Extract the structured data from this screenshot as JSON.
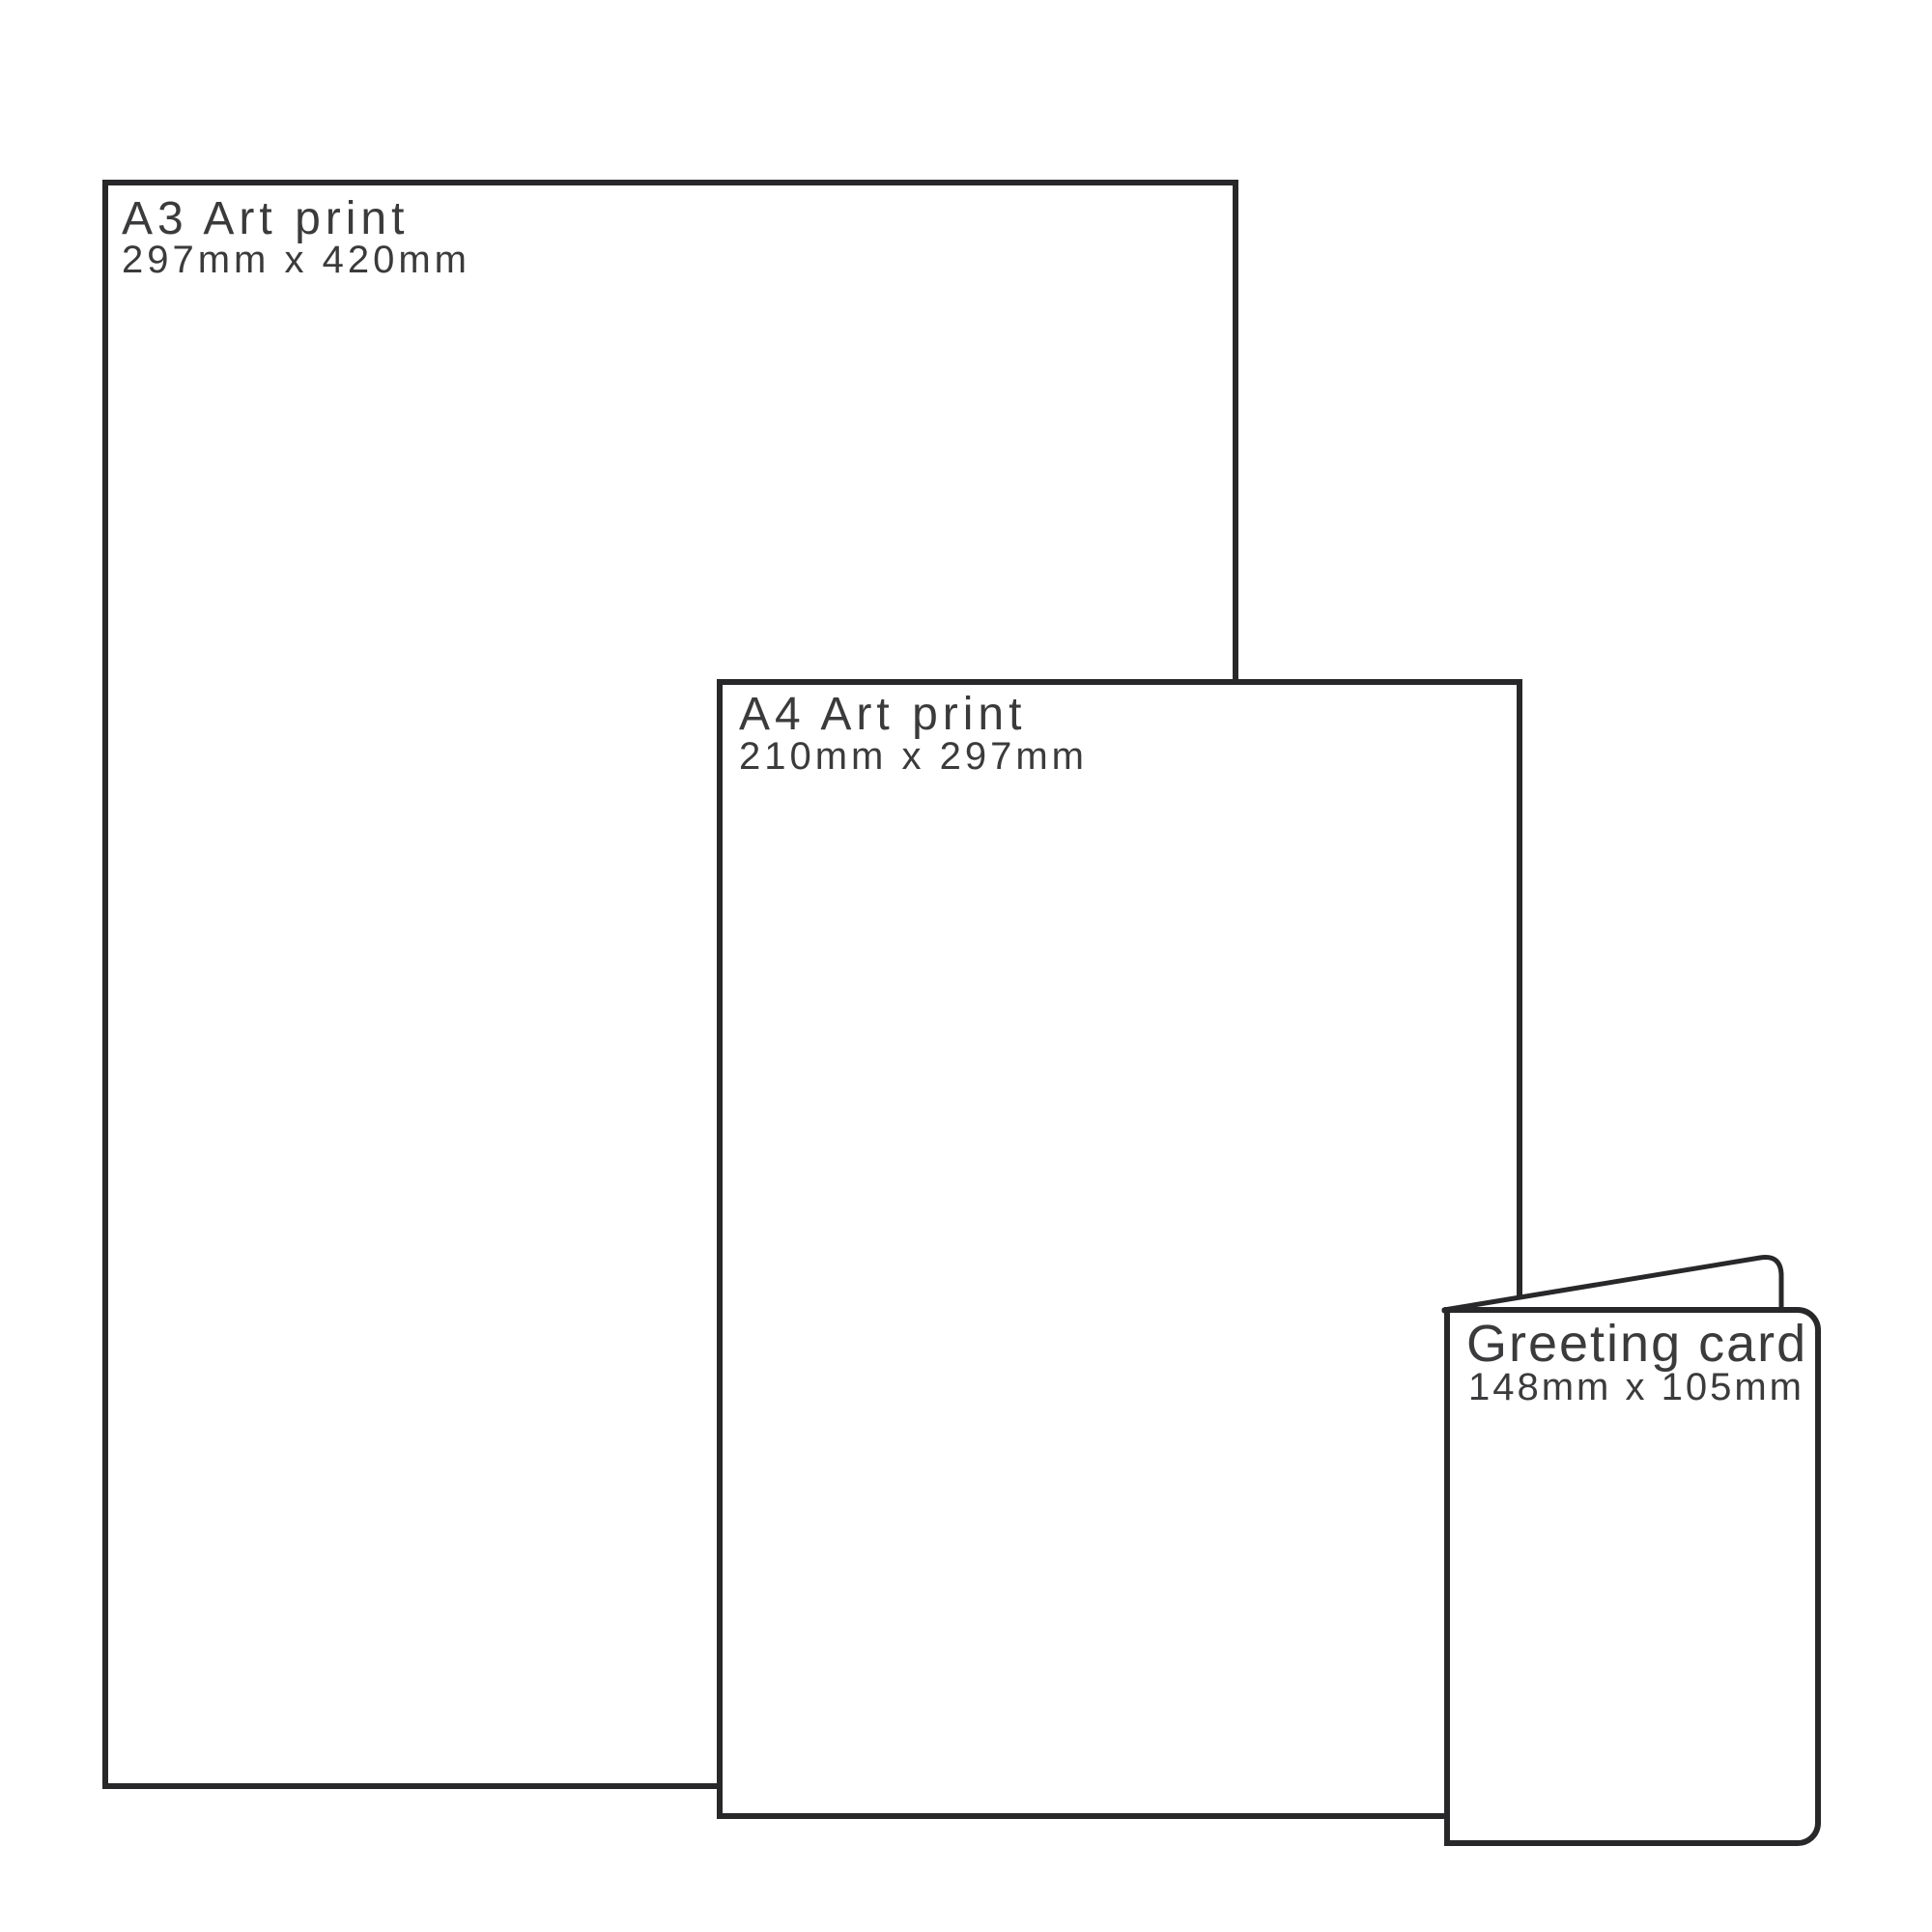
{
  "diagram": {
    "description": "Print product size comparison diagram",
    "colors": {
      "background": "#ffffff",
      "outline": "#28282a",
      "label_text": "#3b3b3d"
    },
    "items": [
      {
        "title": "A3 Art print",
        "dimensions": "297mm x 420mm"
      },
      {
        "title": "A4 Art print",
        "dimensions": "210mm x 297mm"
      },
      {
        "title": "Greeting card",
        "dimensions": "148mm x 105mm"
      }
    ]
  }
}
